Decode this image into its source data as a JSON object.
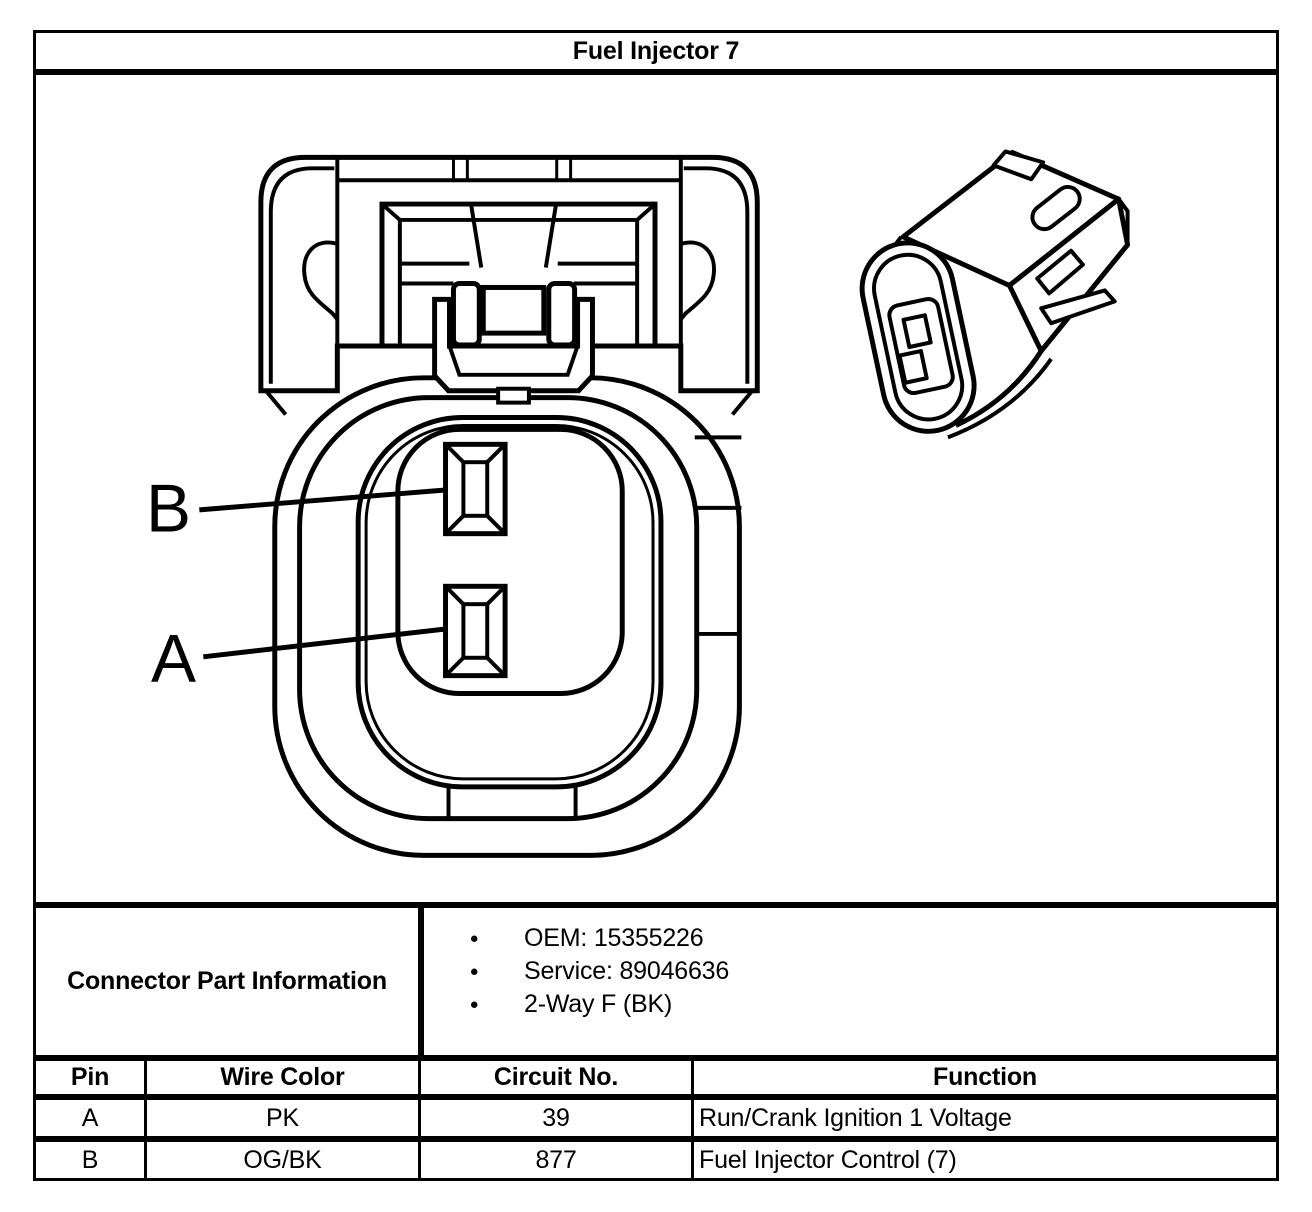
{
  "title": "Fuel Injector 7",
  "diagram": {
    "front_view_pin_labels": {
      "b": "B",
      "a": "A"
    }
  },
  "connector_part_information": {
    "label": "Connector Part Information",
    "bullets": [
      "OEM: 15355226",
      "Service: 89046636",
      "2-Way F (BK)"
    ]
  },
  "pin_table": {
    "headers": {
      "pin": "Pin",
      "wire_color": "Wire Color",
      "circuit_no": "Circuit No.",
      "function": "Function"
    },
    "rows": [
      {
        "pin": "A",
        "wire_color": "PK",
        "circuit_no": "39",
        "function": "Run/Crank Ignition 1 Voltage"
      },
      {
        "pin": "B",
        "wire_color": "OG/BK",
        "circuit_no": "877",
        "function": "Fuel Injector Control (7)"
      }
    ]
  },
  "colors": {
    "line": "#000000",
    "background": "#ffffff"
  }
}
